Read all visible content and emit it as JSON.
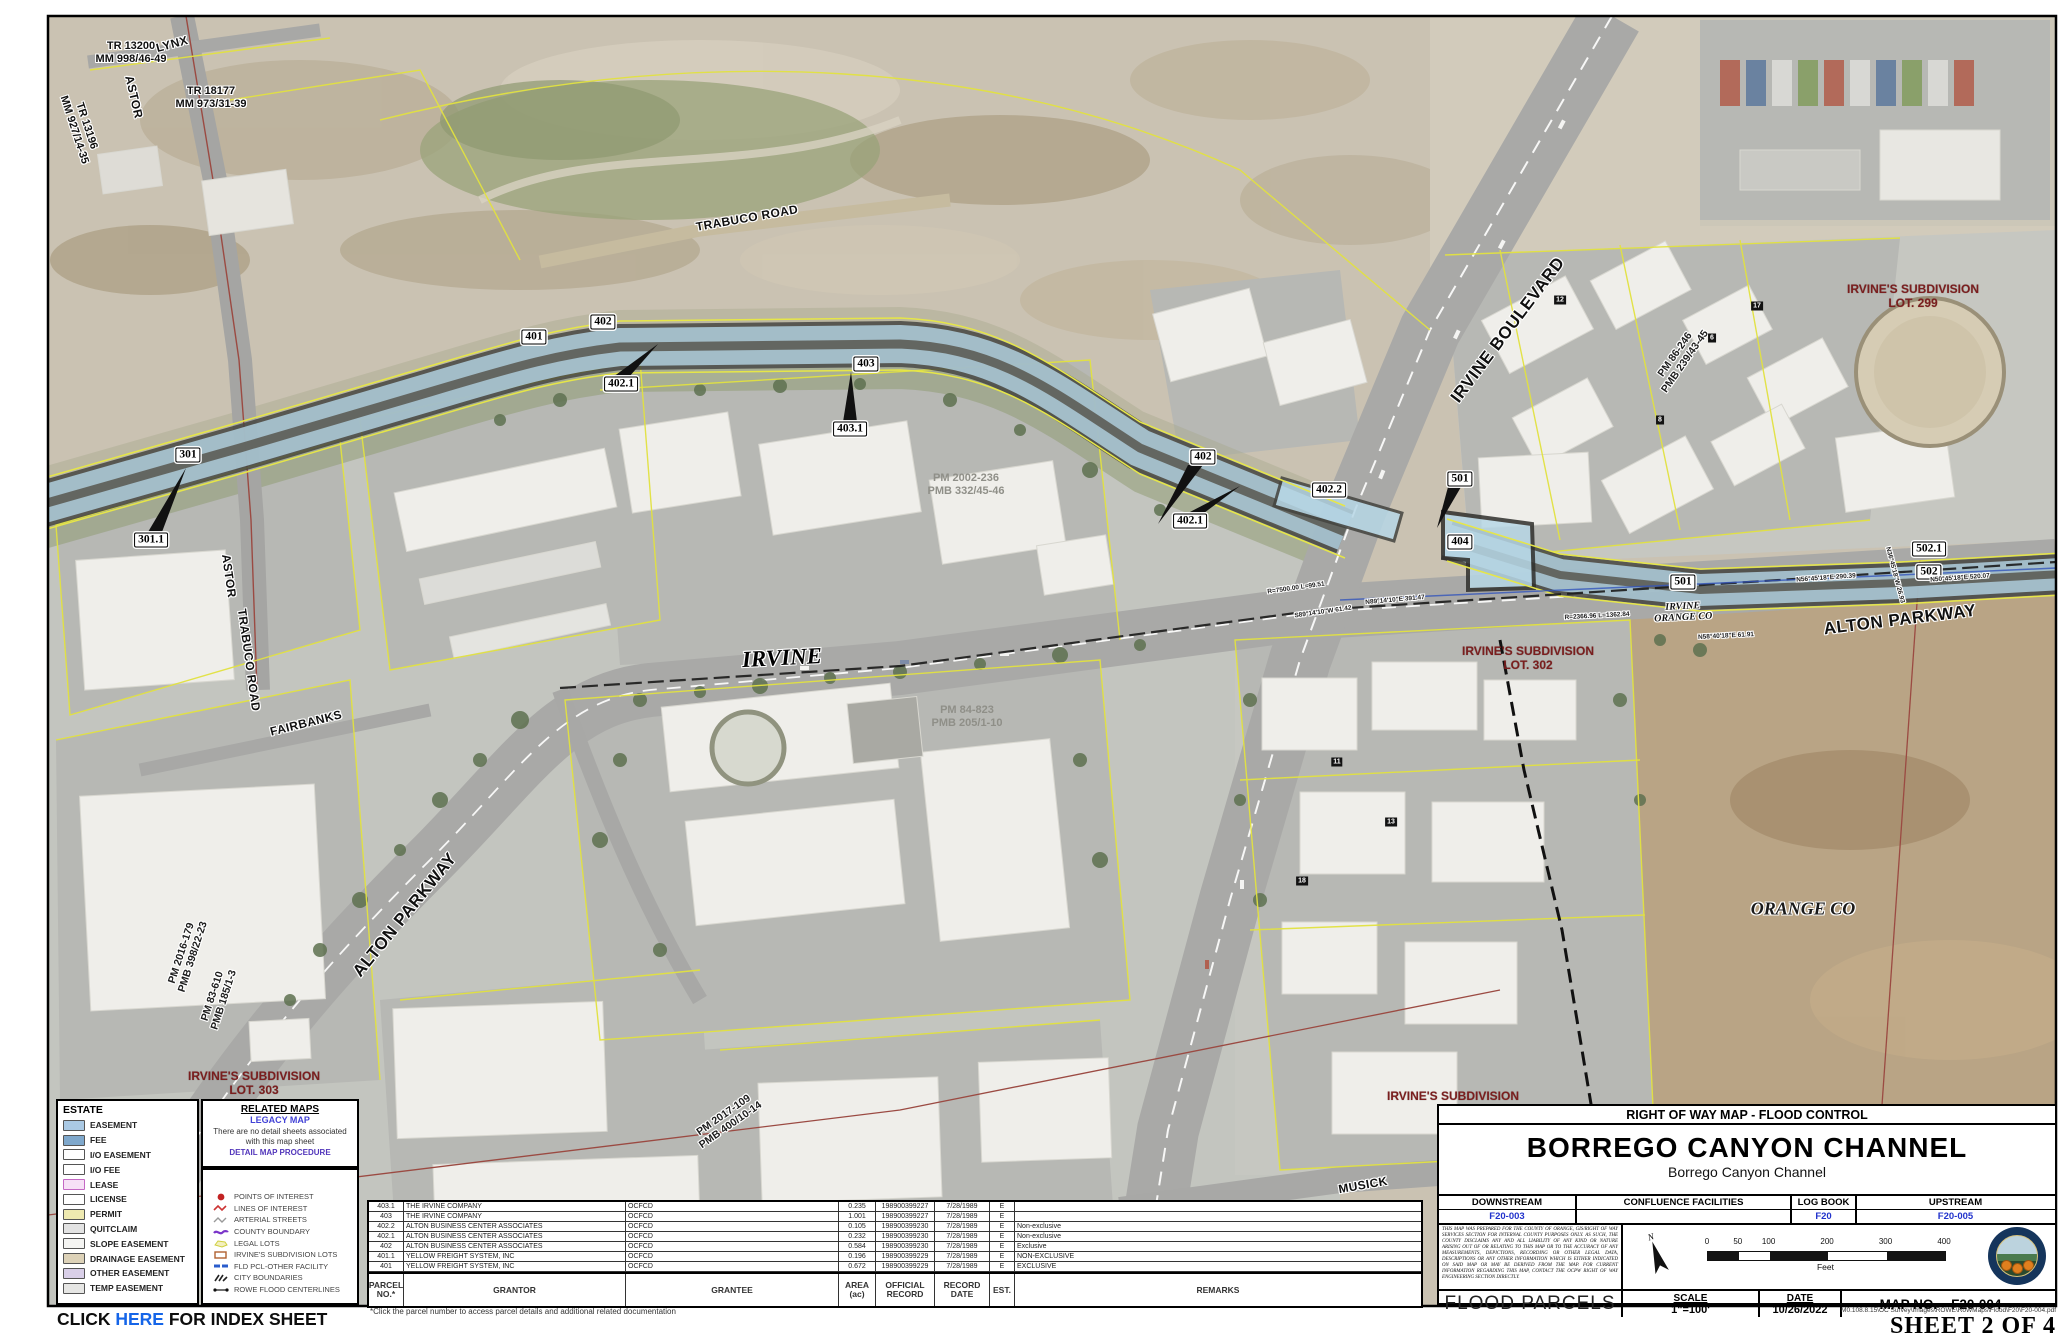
{
  "legend": {
    "estate": {
      "title": "ESTATE",
      "items": [
        {
          "label": "EASEMENT",
          "color": "#aac9e4",
          "style": "solid"
        },
        {
          "label": "FEE",
          "color": "#7fa8cc",
          "style": "solid"
        },
        {
          "label": "I/O EASEMENT",
          "color": "#ffffff",
          "style": "solid"
        },
        {
          "label": "I/O FEE",
          "color": "#ffffff",
          "style": "hatch"
        },
        {
          "label": "LEASE",
          "color": "#f6e0f6",
          "style": "pink"
        },
        {
          "label": "LICENSE",
          "color": "#ffffff",
          "style": "solid"
        },
        {
          "label": "PERMIT",
          "color": "#eee9b0",
          "style": "hatch"
        },
        {
          "label": "QUITCLAIM",
          "color": "#e2e2e2",
          "style": "hatch"
        },
        {
          "label": "SLOPE EASEMENT",
          "color": "#f4f4f2",
          "style": "solid"
        },
        {
          "label": "DRAINAGE EASEMENT",
          "color": "#ddd2b8",
          "style": "solid"
        },
        {
          "label": "OTHER EASEMENT",
          "color": "#d9cfe8",
          "style": "solid"
        },
        {
          "label": "TEMP EASEMENT",
          "color": "#e6e6e4",
          "style": "solid"
        }
      ]
    },
    "related_maps": {
      "title": "RELATED MAPS",
      "link1": "LEGACY MAP",
      "note": "There are no detail sheets associated with this map sheet",
      "link2": "DETAIL MAP PROCEDURE"
    },
    "symbols": [
      {
        "label": "POINTS OF INTEREST",
        "icon": "poi"
      },
      {
        "label": "LINES OF INTEREST",
        "icon": "lines"
      },
      {
        "label": "ARTERIAL STREETS",
        "icon": "arterial"
      },
      {
        "label": "COUNTY BOUNDARY",
        "icon": "county"
      },
      {
        "label": "LEGAL LOTS",
        "icon": "legal"
      },
      {
        "label": "IRVINE'S SUBDIVISION LOTS",
        "icon": "subdiv"
      },
      {
        "label": "FLD PCL-OTHER FACILITY",
        "icon": "fldpcl"
      },
      {
        "label": "CITY BOUNDARIES",
        "icon": "city"
      },
      {
        "label": "ROWE FLOOD CENTERLINES",
        "icon": "rowe"
      }
    ]
  },
  "index_link": {
    "pre": "CLICK ",
    "link": "HERE",
    "post": " FOR INDEX SHEET"
  },
  "table": {
    "columns": [
      "PARCEL\nNO.*",
      "GRANTOR",
      "GRANTEE",
      "AREA\n(ac)",
      "OFFICIAL\nRECORD",
      "RECORD\nDATE",
      "EST.",
      "REMARKS"
    ],
    "rows": [
      {
        "parcel": "403.1",
        "grantor": "THE IRVINE COMPANY",
        "grantee": "OCFCD",
        "area": "0.235",
        "record": "198900399227",
        "date": "7/28/1989",
        "est": "E",
        "remarks": ""
      },
      {
        "parcel": "403",
        "grantor": "THE IRVINE COMPANY",
        "grantee": "OCFCD",
        "area": "1.001",
        "record": "198900399227",
        "date": "7/28/1989",
        "est": "E",
        "remarks": ""
      },
      {
        "parcel": "402.2",
        "grantor": "ALTON BUSINESS CENTER ASSOCIATES",
        "grantee": "OCFCD",
        "area": "0.105",
        "record": "198900399230",
        "date": "7/28/1989",
        "est": "E",
        "remarks": "Non-exclusive"
      },
      {
        "parcel": "402.1",
        "grantor": "ALTON BUSINESS CENTER ASSOCIATES",
        "grantee": "OCFCD",
        "area": "0.232",
        "record": "198900399230",
        "date": "7/28/1989",
        "est": "E",
        "remarks": "Non-exclusive"
      },
      {
        "parcel": "402",
        "grantor": "ALTON BUSINESS CENTER ASSOCIATES",
        "grantee": "OCFCD",
        "area": "0.584",
        "record": "198900399230",
        "date": "7/28/1989",
        "est": "E",
        "remarks": "Exclusive"
      },
      {
        "parcel": "401.1",
        "grantor": "YELLOW FREIGHT SYSTEM, INC",
        "grantee": "OCFCD",
        "area": "0.196",
        "record": "198900399229",
        "date": "7/28/1989",
        "est": "E",
        "remarks": "NON-EXCLUSIVE"
      },
      {
        "parcel": "401",
        "grantor": "YELLOW FREIGHT SYSTEM, INC",
        "grantee": "OCFCD",
        "area": "0.672",
        "record": "198900399229",
        "date": "7/28/1989",
        "est": "E",
        "remarks": "EXCLUSIVE"
      }
    ],
    "footnote": "*Click the parcel number to access parcel details and additional related documentation"
  },
  "title_block": {
    "header": "RIGHT OF WAY MAP - FLOOD CONTROL",
    "title": "BORREGO CANYON CHANNEL",
    "subtitle": "Borrego Canyon Channel",
    "cols": {
      "downstream_label": "DOWNSTREAM",
      "downstream": "F20-003",
      "confluence_label": "CONFLUENCE FACILITIES",
      "confluence": "",
      "logbook_label": "LOG BOOK",
      "logbook": "F20",
      "upstream_label": "UPSTREAM",
      "upstream": "F20-005"
    },
    "disclaimer": "THIS MAP WAS PREPARED FOR THE COUNTY OF ORANGE, GIS/RIGHT OF WAY SERVICES SECTION FOR INTERNAL COUNTY PURPOSES ONLY. AS SUCH, THE COUNTY DISCLAIMS ANY AND ALL LIABILITY OF ANY KIND OR NATURE ARISING OUT OF OR RELATING TO THIS MAP OR TO THE ACCURACY OF ANY MEASUREMENTS, DEPICTIONS, RECORDING OR OTHER LEGAL DATA, DESCRIPTIONS OR ANY OTHER INFORMATION WHICH IS EITHER INDICATED ON SAID MAP OR MAY BE DERIVED FROM THE MAP. FOR CURRENT INFORMATION REGARDING THIS MAP, CONTACT THE OCPW RIGHT OF WAY ENGINEERING SECTION DIRECTLY.",
    "scalebar": {
      "ticks": [
        0,
        50,
        100,
        200,
        300,
        400
      ],
      "unit": "Feet"
    },
    "footer": {
      "name": "FLOOD PARCELS",
      "scale_label": "SCALE",
      "scale_value": "1\"=100'",
      "date_label": "DATE",
      "date_value": "10/26/2022",
      "mapno_label": "MAP NO.",
      "mapno_value": "F20-004"
    }
  },
  "sheet": {
    "path": "M0.108.8.15\\OC Survey\\Images\\ROWE\\RoWMaps\\Flood\\F20\\F20-004.pdf",
    "label": "SHEET 2 OF 4"
  },
  "map": {
    "labels": [
      {
        "t": "301",
        "x": 188,
        "y": 455,
        "c": "parcel"
      },
      {
        "t": "301.1",
        "x": 151,
        "y": 540,
        "c": "parcel"
      },
      {
        "t": "401",
        "x": 534,
        "y": 337,
        "c": "parcel"
      },
      {
        "t": "402",
        "x": 603,
        "y": 322,
        "c": "parcel"
      },
      {
        "t": "402.1",
        "x": 621,
        "y": 384,
        "c": "parcel"
      },
      {
        "t": "403",
        "x": 866,
        "y": 364,
        "c": "parcel"
      },
      {
        "t": "403.1",
        "x": 850,
        "y": 429,
        "c": "parcel"
      },
      {
        "t": "402",
        "x": 1203,
        "y": 457,
        "c": "parcel"
      },
      {
        "t": "402.1",
        "x": 1190,
        "y": 521,
        "c": "parcel"
      },
      {
        "t": "402.2",
        "x": 1329,
        "y": 490,
        "c": "parcel"
      },
      {
        "t": "501",
        "x": 1460,
        "y": 479,
        "c": "parcel"
      },
      {
        "t": "404",
        "x": 1460,
        "y": 542,
        "c": "parcel"
      },
      {
        "t": "501",
        "x": 1683,
        "y": 582,
        "c": "parcel"
      },
      {
        "t": "502.1",
        "x": 1929,
        "y": 549,
        "c": "parcel"
      },
      {
        "t": "502",
        "x": 1929,
        "y": 572,
        "c": "parcel"
      },
      {
        "t": "LYNX",
        "x": 172,
        "y": 44,
        "r": -15,
        "c": "street"
      },
      {
        "t": "ASTOR",
        "x": 134,
        "y": 97,
        "r": 77,
        "c": "street"
      },
      {
        "t": "TRABUCO ROAD",
        "x": 747,
        "y": 218,
        "r": -10,
        "c": "street"
      },
      {
        "t": "IRVINE BOULEVARD",
        "x": 1508,
        "y": 330,
        "r": -53,
        "c": "street lg"
      },
      {
        "t": "ASTOR",
        "x": 229,
        "y": 576,
        "r": 82,
        "c": "street"
      },
      {
        "t": "TRABUCO ROAD",
        "x": 249,
        "y": 660,
        "r": 82,
        "c": "street"
      },
      {
        "t": "FAIRBANKS",
        "x": 306,
        "y": 723,
        "r": -14,
        "c": "street"
      },
      {
        "t": "ALTON PARKWAY",
        "x": 405,
        "y": 915,
        "r": -51,
        "c": "street lg"
      },
      {
        "t": "ALTON PARKWAY",
        "x": 1900,
        "y": 620,
        "r": -7,
        "c": "street lg"
      },
      {
        "t": "MUSICK",
        "x": 1363,
        "y": 1185,
        "r": -10,
        "c": "street"
      },
      {
        "t": "IRVINE",
        "x": 782,
        "y": 658,
        "r": -3,
        "c": "city"
      },
      {
        "t": "ORANGE CO",
        "x": 1803,
        "y": 909,
        "r": 0,
        "c": "city2"
      },
      {
        "t": "IRVINE\nORANGE CO",
        "x": 1683,
        "y": 612,
        "r": -3,
        "c": "bpair"
      },
      {
        "t": "IRVINE'S SUBDIVISION\nLOT. 299",
        "x": 1913,
        "y": 296,
        "c": "subdiv"
      },
      {
        "t": "IRVINE'S SUBDIVISION\nLOT. 302",
        "x": 1528,
        "y": 658,
        "c": "subdiv"
      },
      {
        "t": "IRVINE'S SUBDIVISION\nLOT. 303",
        "x": 254,
        "y": 1083,
        "c": "subdiv"
      },
      {
        "t": "IRVINE'S SUBDIVISION",
        "x": 1453,
        "y": 1096,
        "c": "subdiv"
      },
      {
        "t": "PM 2002-236\nPMB 332/45-46",
        "x": 966,
        "y": 485,
        "c": "pmgray"
      },
      {
        "t": "PM 84-823\nPMB 205/1-10",
        "x": 967,
        "y": 717,
        "c": "pmgray"
      },
      {
        "t": "PM 2017-109\nPMB 400/10-14",
        "x": 727,
        "y": 1120,
        "r": -35,
        "c": "pmhalo"
      },
      {
        "t": "PM 2016-179\nPMB 398/22-23",
        "x": 187,
        "y": 955,
        "r": -72,
        "c": "pmhalo"
      },
      {
        "t": "PM 83-610\nPMB 185/1-3",
        "x": 218,
        "y": 998,
        "r": -72,
        "c": "pmhalo"
      },
      {
        "t": "PM 86-246\nPMB 239/43-45",
        "x": 1680,
        "y": 358,
        "r": -55,
        "c": "pmhalo"
      },
      {
        "t": "TR 13200\nMM 998/46-49",
        "x": 131,
        "y": 53,
        "c": "tract"
      },
      {
        "t": "TR 18177\nMM 973/31-39",
        "x": 211,
        "y": 98,
        "c": "tract"
      },
      {
        "t": "TR 13196\nMM 927/14-35",
        "x": 80,
        "y": 128,
        "r": 72,
        "c": "tract"
      },
      {
        "t": "R=7500.00 L=99.51",
        "x": 1296,
        "y": 588,
        "r": -8,
        "c": "bearing"
      },
      {
        "t": "S89°14'10\"W 61.42",
        "x": 1323,
        "y": 612,
        "r": -8,
        "c": "bearing"
      },
      {
        "t": "N89°14'10\"E 391.47",
        "x": 1395,
        "y": 600,
        "r": -5,
        "c": "bearing"
      },
      {
        "t": "N56°45'18\"E 290.39",
        "x": 1826,
        "y": 578,
        "r": -4,
        "c": "bearing"
      },
      {
        "t": "N36°45'18\"W 26.93",
        "x": 1895,
        "y": 575,
        "r": 75,
        "c": "bearing"
      },
      {
        "t": "N50°45'18\"E 520.07",
        "x": 1960,
        "y": 578,
        "r": -4,
        "c": "bearing"
      },
      {
        "t": "R=2366.96 L=1362.84",
        "x": 1597,
        "y": 616,
        "r": -3,
        "c": "bearing"
      },
      {
        "t": "N58°40'18\"E 61.91",
        "x": 1726,
        "y": 636,
        "r": -3,
        "c": "bearing"
      },
      {
        "t": "17",
        "x": 1757,
        "y": 306,
        "c": "lotmark"
      },
      {
        "t": "6",
        "x": 1712,
        "y": 338,
        "c": "lotmark"
      },
      {
        "t": "8",
        "x": 1660,
        "y": 420,
        "c": "lotmark"
      },
      {
        "t": "12",
        "x": 1560,
        "y": 300,
        "c": "lotmark"
      },
      {
        "t": "11",
        "x": 1337,
        "y": 762,
        "c": "lotmark"
      },
      {
        "t": "13",
        "x": 1391,
        "y": 822,
        "c": "lotmark"
      },
      {
        "t": "18",
        "x": 1302,
        "y": 881,
        "c": "lotmark"
      }
    ]
  }
}
